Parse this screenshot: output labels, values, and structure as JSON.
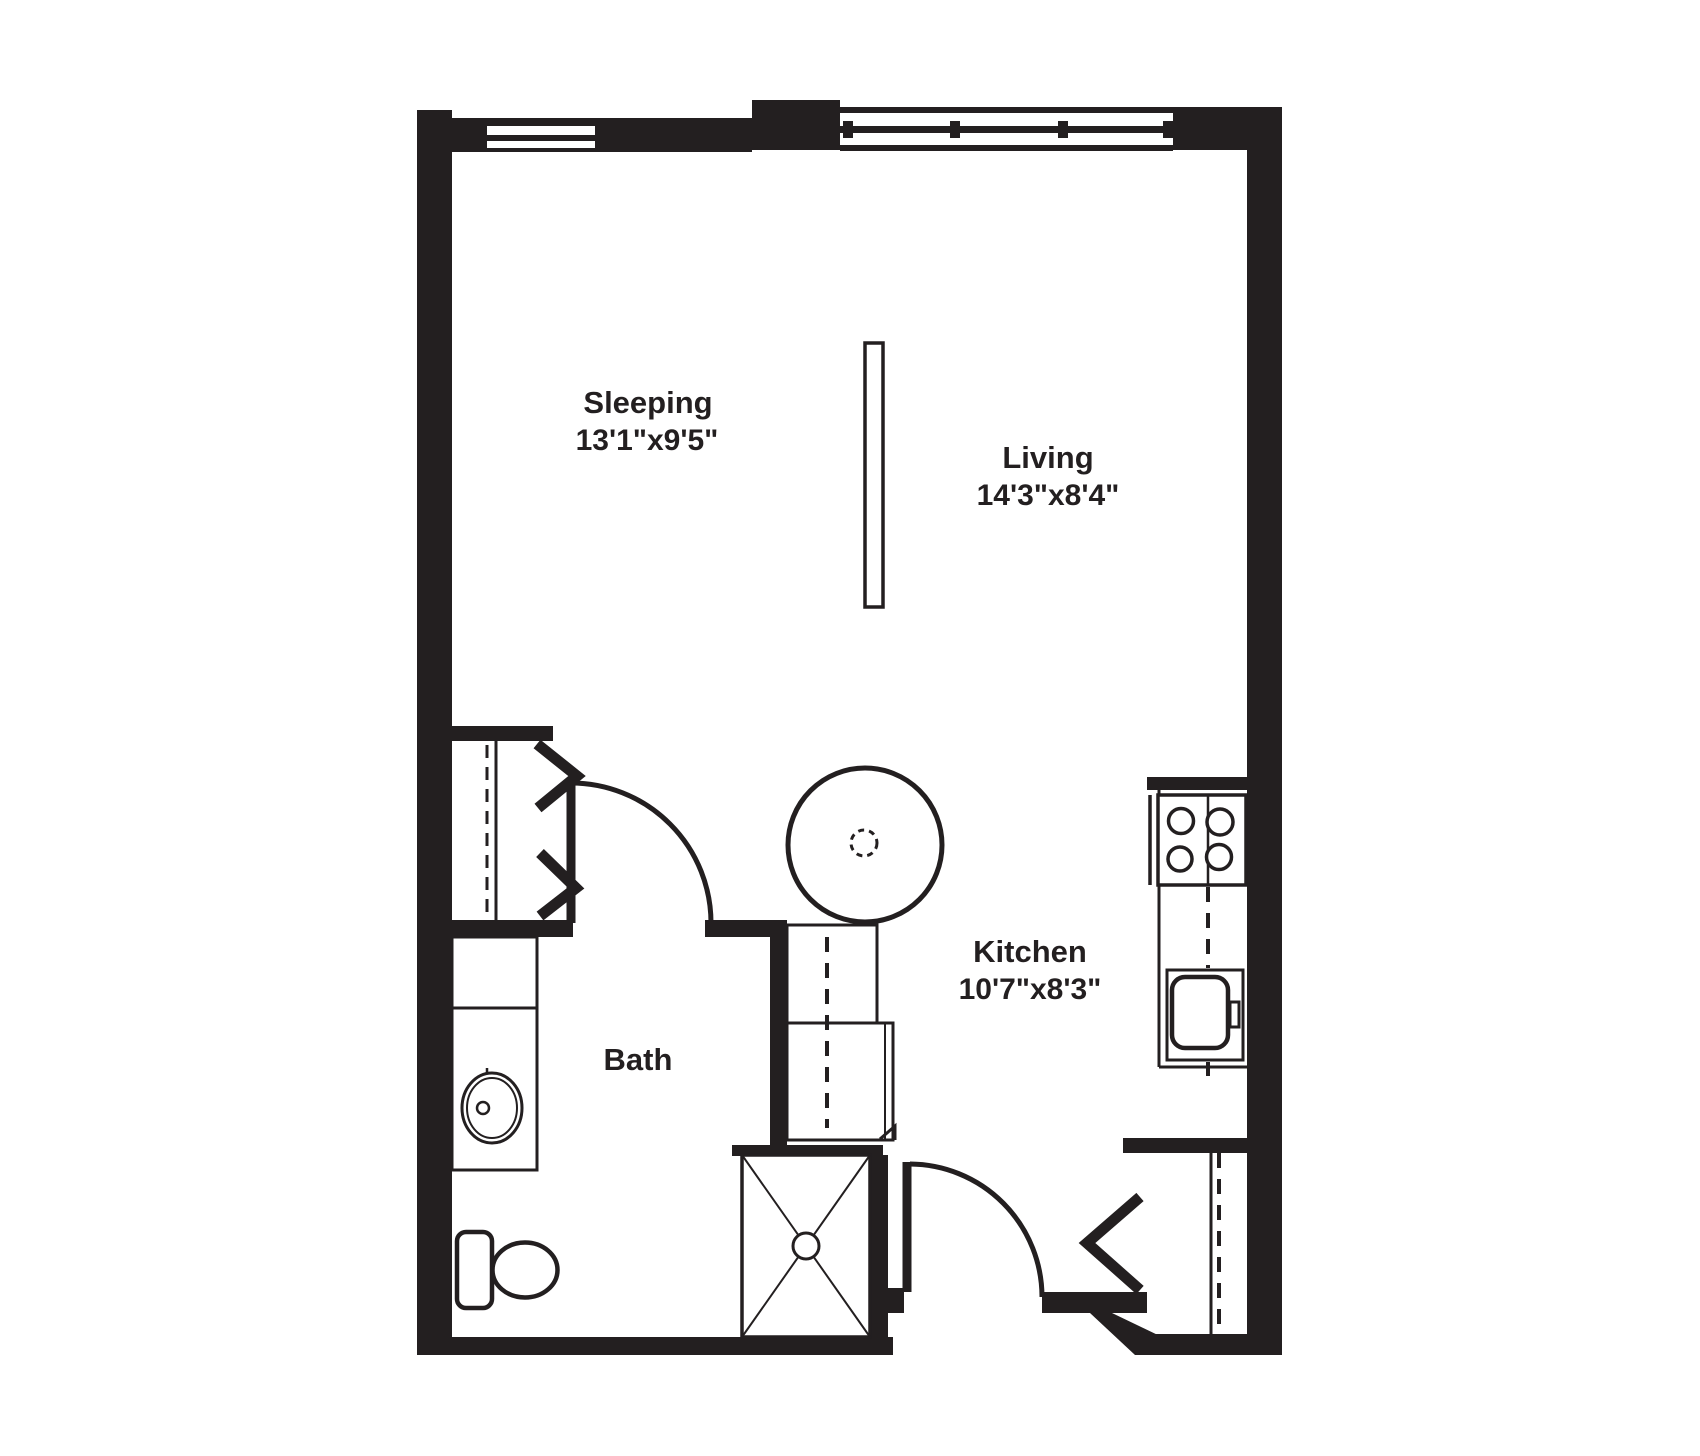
{
  "plan": {
    "type": "floor-plan",
    "background_color": "#ffffff",
    "wall_color": "#231f20",
    "rooms": {
      "sleeping": {
        "label": "Sleeping",
        "dimensions": "13'1\"x9'5\""
      },
      "living": {
        "label": "Living",
        "dimensions": "14'3\"x8'4\""
      },
      "kitchen": {
        "label": "Kitchen",
        "dimensions": "10'7\"x8'3\""
      },
      "bath": {
        "label": "Bath"
      }
    },
    "fixtures": [
      "window",
      "bifold-closet-doors",
      "closet-rod-dashed-line",
      "bath-swing-door",
      "water-heater",
      "mechanical-cabinet",
      "shower-stall",
      "shower-drain",
      "entry-swing-door",
      "entry-closet",
      "stove-four-burners",
      "kitchen-counter",
      "kitchen-sink",
      "vanity-counter",
      "vanity-sink",
      "toilet",
      "room-divider-partition"
    ]
  }
}
